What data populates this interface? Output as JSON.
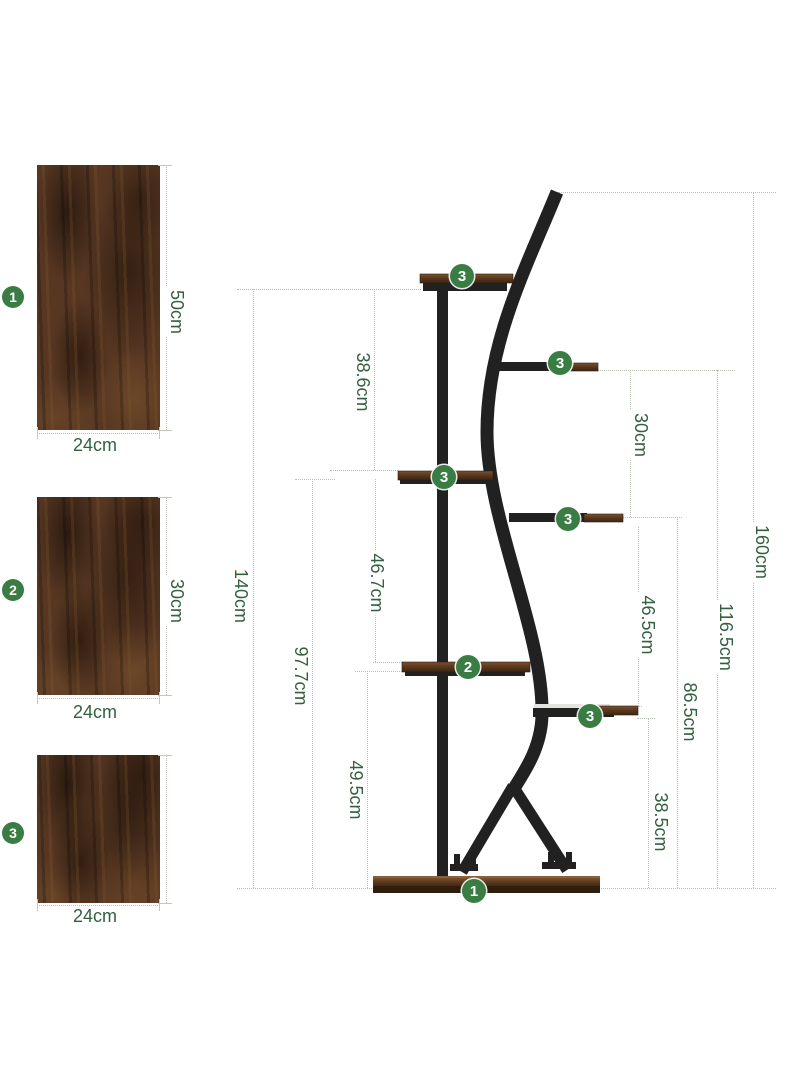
{
  "colors": {
    "badge_green": "#3a7d44",
    "dim_text_green": "#33603f",
    "dotted_line": "#b7bfaf",
    "metal_black": "#212121",
    "wood_brown": "#573722"
  },
  "panels": [
    {
      "badge": "1",
      "height": "50cm",
      "width": "24cm"
    },
    {
      "badge": "2",
      "height": "30cm",
      "width": "24cm"
    },
    {
      "badge": "3",
      "width": "24cm"
    }
  ],
  "stand": {
    "badges": [
      "3",
      "3",
      "3",
      "3",
      "2",
      "3",
      "1"
    ],
    "dims": {
      "h140": "140cm",
      "h386": "38.6cm",
      "h977": "97.7cm",
      "h467": "46.7cm",
      "h495": "49.5cm",
      "h30": "30cm",
      "h465": "46.5cm",
      "h865": "86.5cm",
      "h385": "38.5cm",
      "h1165": "116.5cm",
      "h160": "160cm"
    }
  }
}
